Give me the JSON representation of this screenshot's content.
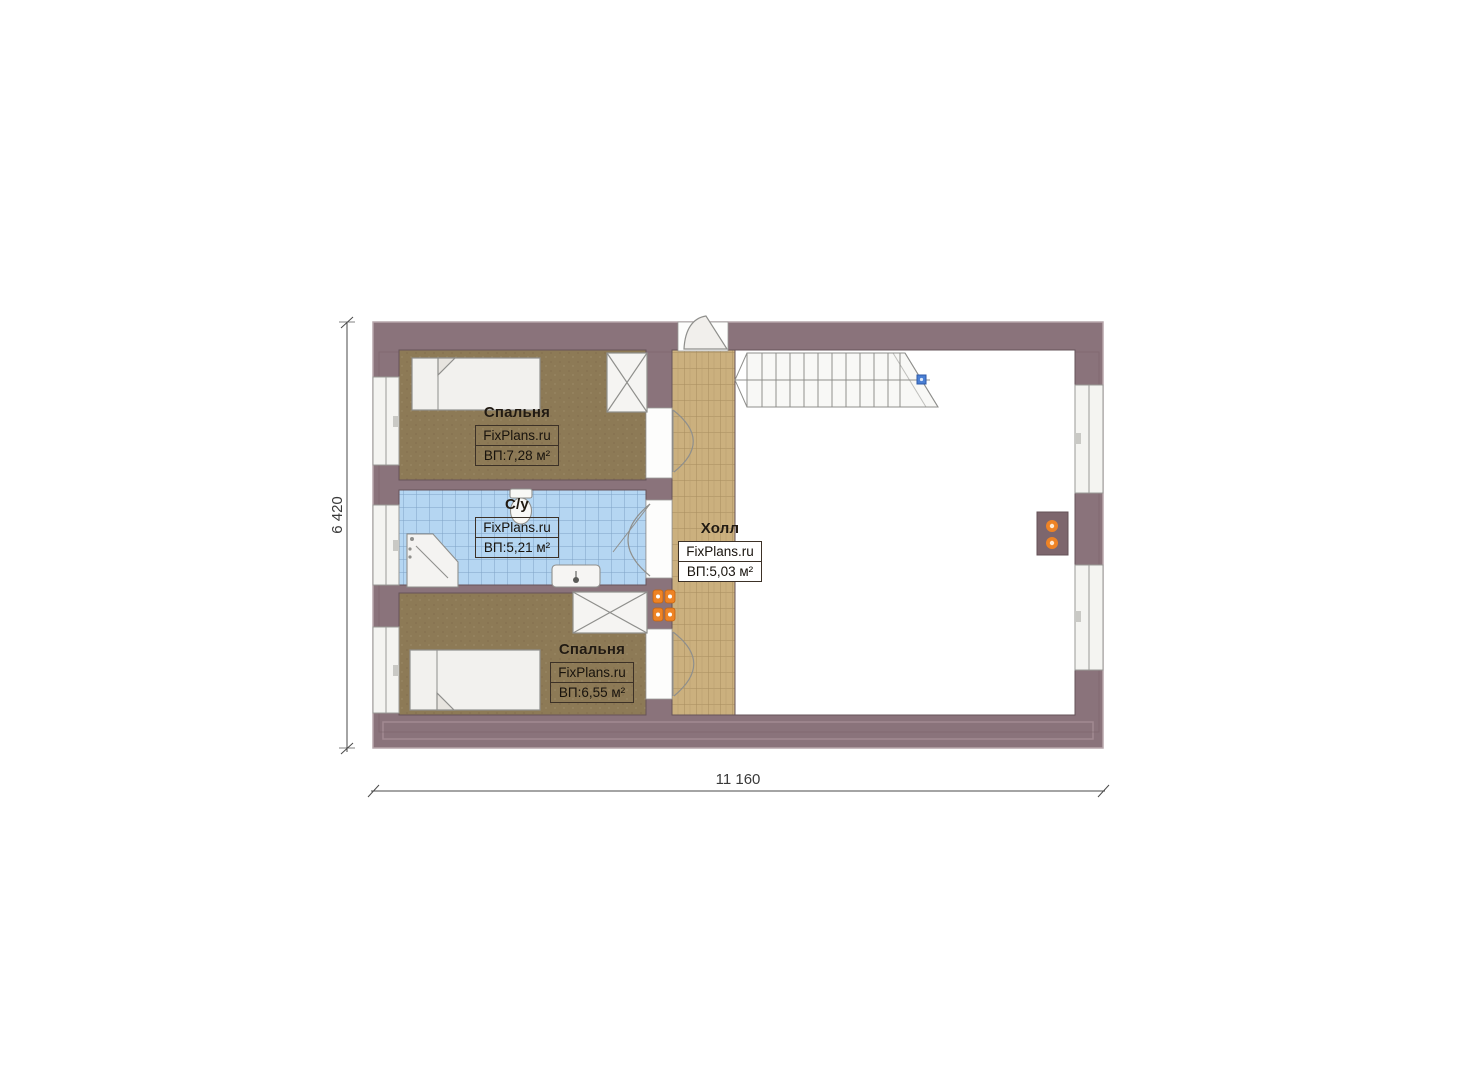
{
  "plan": {
    "title": "Floor plan (second floor)",
    "rooms": [
      {
        "key": "bedroom-top",
        "name": "Спальня",
        "brand": "FixPlans.ru",
        "area": "ВП:7,28 м²"
      },
      {
        "key": "bathroom",
        "name": "С/у",
        "brand": "FixPlans.ru",
        "area": "ВП:5,21 м²"
      },
      {
        "key": "hall",
        "name": "Холл",
        "brand": "FixPlans.ru",
        "area": "ВП:5,03 м²"
      },
      {
        "key": "bedroom-bottom",
        "name": "Спальня",
        "brand": "FixPlans.ru",
        "area": "ВП:6,55 м²"
      }
    ],
    "dimensions": {
      "height_label": "6 420",
      "width_label": "11 160"
    },
    "colors": {
      "wall": "#8a737b",
      "wall_dark_edge": "#6e5a61",
      "bedroom_floor": "#8d7a56",
      "bathroom_tile": "#b5d6f2",
      "bathroom_grid": "#7fa3c6",
      "hall_tile": "#cbb07e",
      "hall_grid": "#a78d5e",
      "fixture_fill": "#f3f2ef",
      "fixture_stroke": "#8f8f8c",
      "socket_accent": "#ee8325",
      "stair_marker_blue": "#4a7fd4",
      "dimension_line": "#4a4a4a"
    }
  }
}
